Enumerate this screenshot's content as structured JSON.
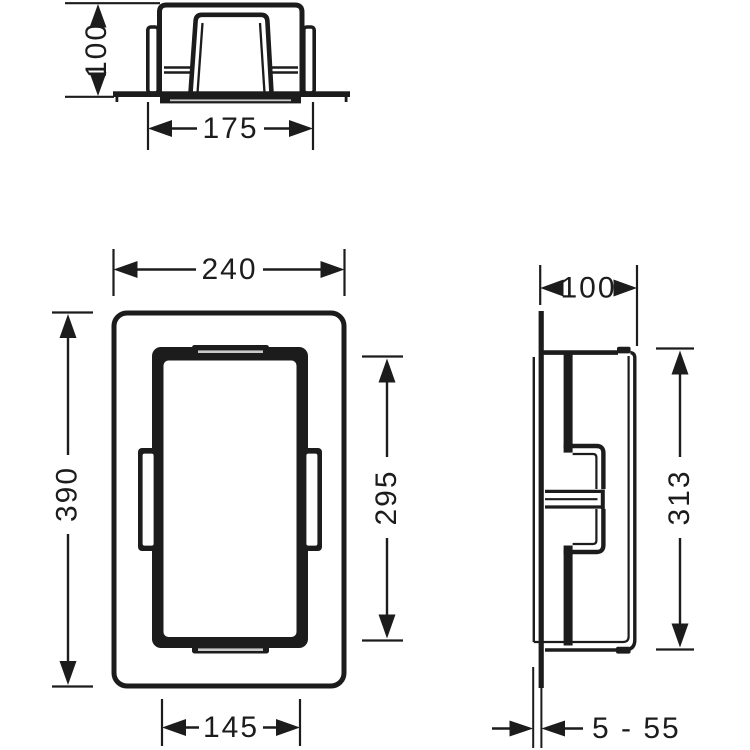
{
  "drawing": {
    "type": "technical-dimension-drawing",
    "colors": {
      "line": "#1c1c1c",
      "background": "#ffffff",
      "slot_gray": "#c9c9c9"
    },
    "dimensions": {
      "top_view": {
        "depth": "100",
        "width_across_clips": "175"
      },
      "front_view": {
        "overall_width": "240",
        "overall_height": "390",
        "frame_height": "295",
        "frame_width": "145"
      },
      "side_view": {
        "depth": "100",
        "body_height": "313",
        "tile_thickness_range": "5 - 55"
      }
    }
  }
}
